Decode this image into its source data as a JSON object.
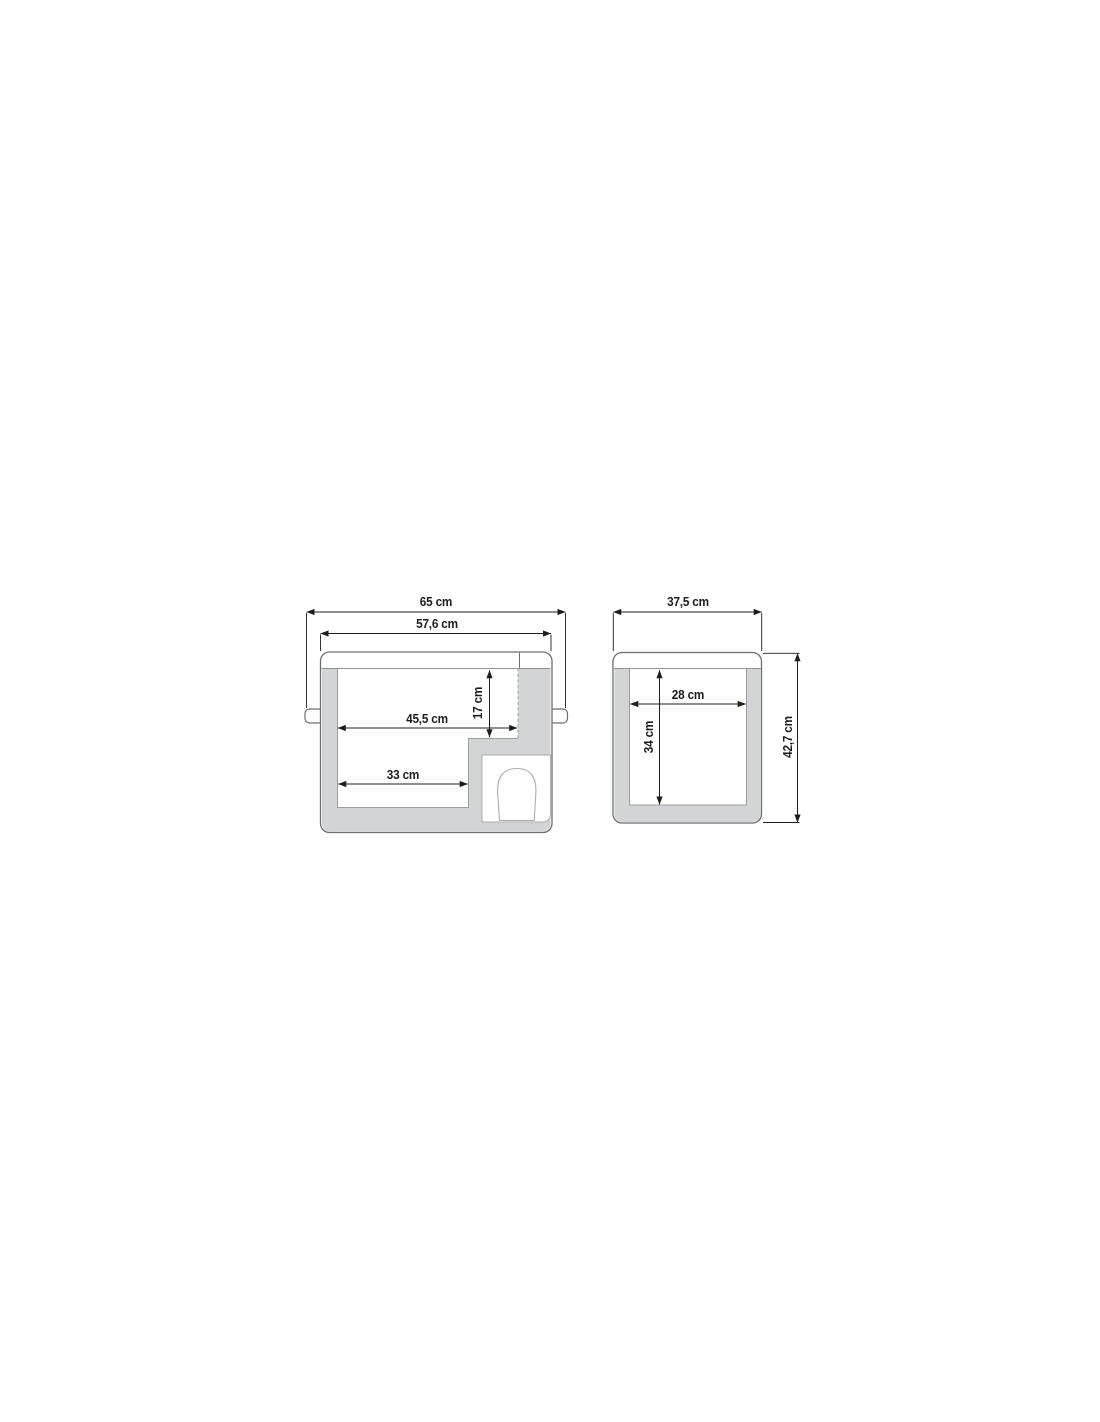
{
  "diagram_title": "cooler-box-dimension-drawing",
  "unit": "cm",
  "colors": {
    "background": "#ffffff",
    "wall_fill": "#d3d4d6",
    "body_outline": "#6d6e70",
    "inner_edge_line": "#9b9da0",
    "compressor_outline": "#aaacae",
    "dimension_line": "#1d1d1b",
    "label_text": "#1d1d1b"
  },
  "views": {
    "side": {
      "name": "side-cross-section",
      "dims": {
        "overall_width": "65 cm",
        "body_width": "57,6 cm",
        "interior_upper_width": "45,5 cm",
        "step_height": "17 cm",
        "interior_lower_width": "33 cm"
      }
    },
    "front": {
      "name": "front-cross-section",
      "dims": {
        "overall_depth": "37,5 cm",
        "interior_width": "28 cm",
        "interior_height": "34 cm",
        "overall_height": "42,7 cm"
      }
    }
  }
}
